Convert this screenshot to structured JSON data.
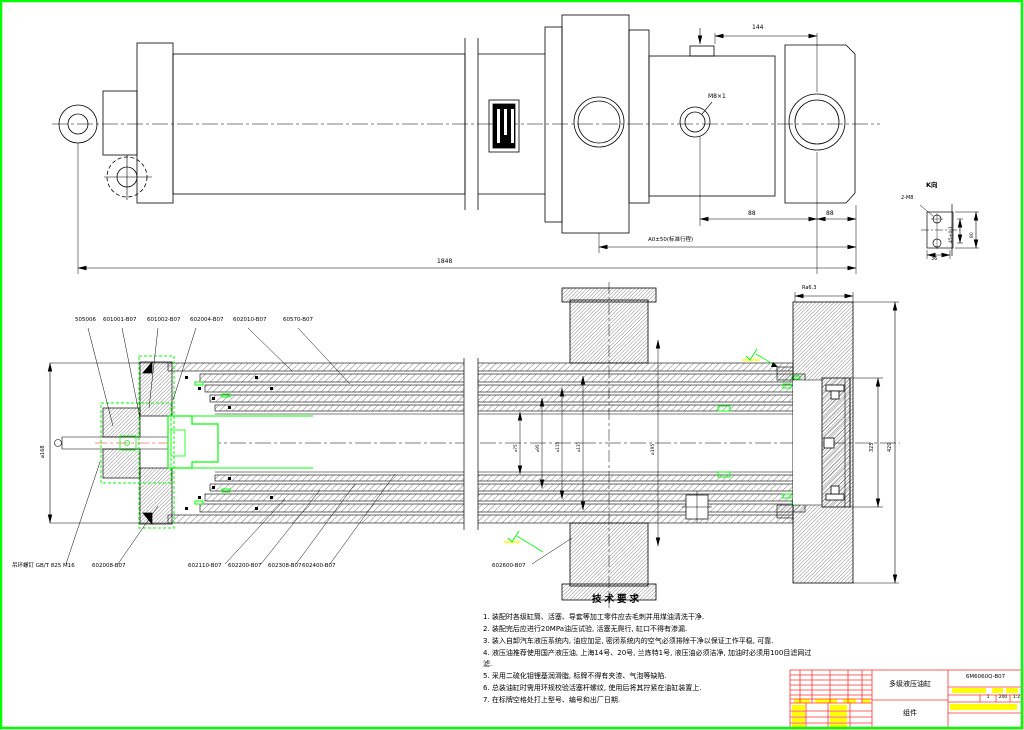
{
  "colors": {
    "background": "#ffffff",
    "border_green": "#00ff00",
    "line_black": "#000000",
    "highlight_green": "#00ff00",
    "centerline_red": "#ff6666",
    "titleblock_red": "#ff3030",
    "titleblock_yellow": "#ffff00"
  },
  "top_view": {
    "dims": {
      "thread_callout": "M8×1",
      "dim_144": "144",
      "dim_88a": "88",
      "dim_88b": "88",
      "stroke_dim": "A0±50(标准行程)",
      "overall_length": "1848"
    }
  },
  "detail_k": {
    "title": "K向",
    "hole_callout": "2-M8",
    "dim_vertical": "45±0.1",
    "dim_right": "80",
    "dim_bottom": "36"
  },
  "section_view": {
    "labels_top": [
      "505006",
      "601001-B07",
      "601002-B07",
      "602004-B07",
      "602010-B07",
      "60570-B07"
    ],
    "labels_bottom": [
      "吊环螺钉 GB/T 825 M16",
      "602008-B07",
      "602110-B07",
      "602200-B07",
      "602308-B07",
      "602400-B07"
    ],
    "label_bottom_mid": "602600-B07",
    "dims": {
      "left_od": "⌀168",
      "stage_d1": "⌀75",
      "stage_d2": "⌀95",
      "stage_d3": "⌀115",
      "stage_d4": "⌀135",
      "pilot_d": "⌀195",
      "flange_inner_h": "325",
      "flange_outer_h": "420",
      "surface_note": "Ra6.3"
    }
  },
  "tech_requirements": {
    "title": "技术要求",
    "items": [
      "1. 装配时各级缸筒、活塞、导套等加工零件应去毛刺并用煤油清洗干净.",
      "2. 装配完后应进行20MPa油压试验, 活塞无爬行, 缸口不得有渗漏.",
      "3. 装入自卸汽车液压系统内, 油应加足, 密闭系统内的空气必须排除干净以保证工作平稳, 可靠.",
      "4. 液压油推荐使用国产液压油, 上海14号、20号, 兰炼特1号, 液压油必须洁净, 加油时必须用100目滤网过滤.",
      "5. 采用二硫化钼锂基润滑脂, 标牌不得有夹渣、气泡等缺陷.",
      "6. 总装油缸时需用环规校验活塞杆螺纹, 使用后将其拧紧在油缸装置上.",
      "7. 在标牌空格处打上型号、编号和出厂日期."
    ]
  },
  "title_block": {
    "product_name": "多级液压油缸",
    "part_name": "组件",
    "drawing_no": "6M6060Q-B07",
    "stage": "1",
    "mass": "200",
    "scale": "1:2"
  }
}
